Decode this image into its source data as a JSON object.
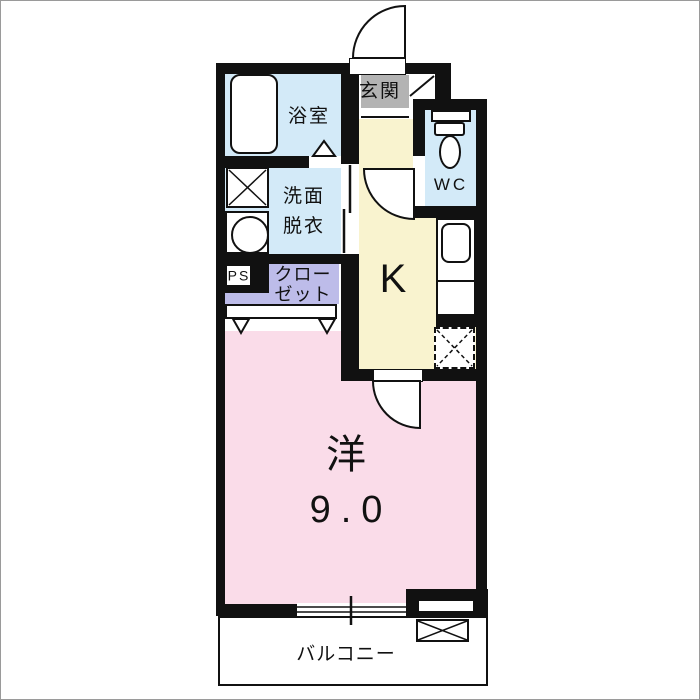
{
  "floorplan": {
    "rooms": {
      "entrance": {
        "label": "玄関"
      },
      "bathroom": {
        "label": "浴室"
      },
      "washroom": {
        "label_line1": "洗面",
        "label_line2": "脱衣"
      },
      "wc": {
        "label": "WC"
      },
      "kitchen": {
        "label": "K"
      },
      "pipe_space": {
        "label": "PS"
      },
      "closet": {
        "label_line1": "クロー",
        "label_line2": "ゼット"
      },
      "western_room": {
        "label": "洋",
        "size": "9.0"
      },
      "balcony": {
        "label": "バルコニー"
      }
    },
    "colors": {
      "wall": "#111111",
      "wet_area_blue": "#d3eaf8",
      "kitchen_yellow": "#f9f3cf",
      "room_pink": "#fadce9",
      "closet_lavender": "#bdbce9",
      "entrance_gray": "#b3b3b3"
    }
  }
}
